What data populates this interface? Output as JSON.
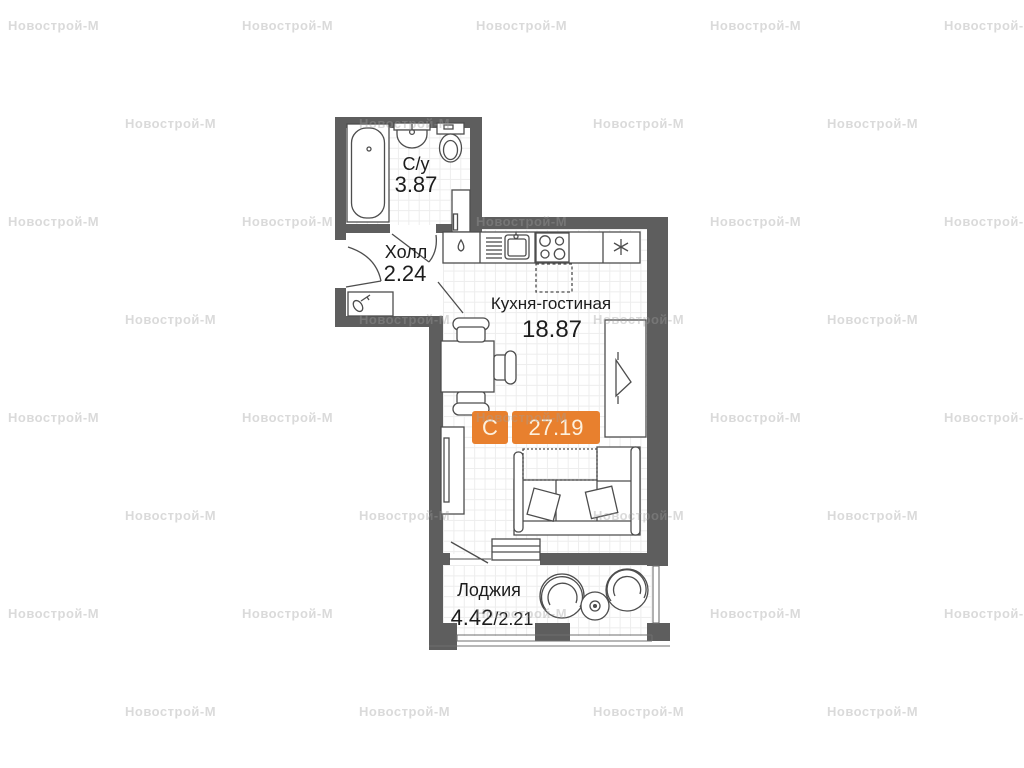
{
  "watermark": {
    "text": "Новострой-М"
  },
  "badge": {
    "unit_type": "С",
    "total_area": "27.19"
  },
  "rooms": {
    "bathroom": {
      "name": "С/у",
      "area": "3.87"
    },
    "hall": {
      "name": "Холл",
      "area": "2.24"
    },
    "kitchen_living": {
      "name": "Кухня-гостиная",
      "area": "18.87"
    },
    "loggia": {
      "name": "Лоджия",
      "area_main": "4.42",
      "area_reduced": "/2.21"
    }
  },
  "icons": {
    "fridge": "snowflake-asterisk-icon",
    "washing_place": "water-drop-icon",
    "entrance_cabinet": "key-icon"
  },
  "colors": {
    "accent_orange": "#e8802e",
    "wall_gray": "#5e5e5e",
    "furniture_line": "#4d4d4d",
    "watermark_gray": "#dadada"
  }
}
